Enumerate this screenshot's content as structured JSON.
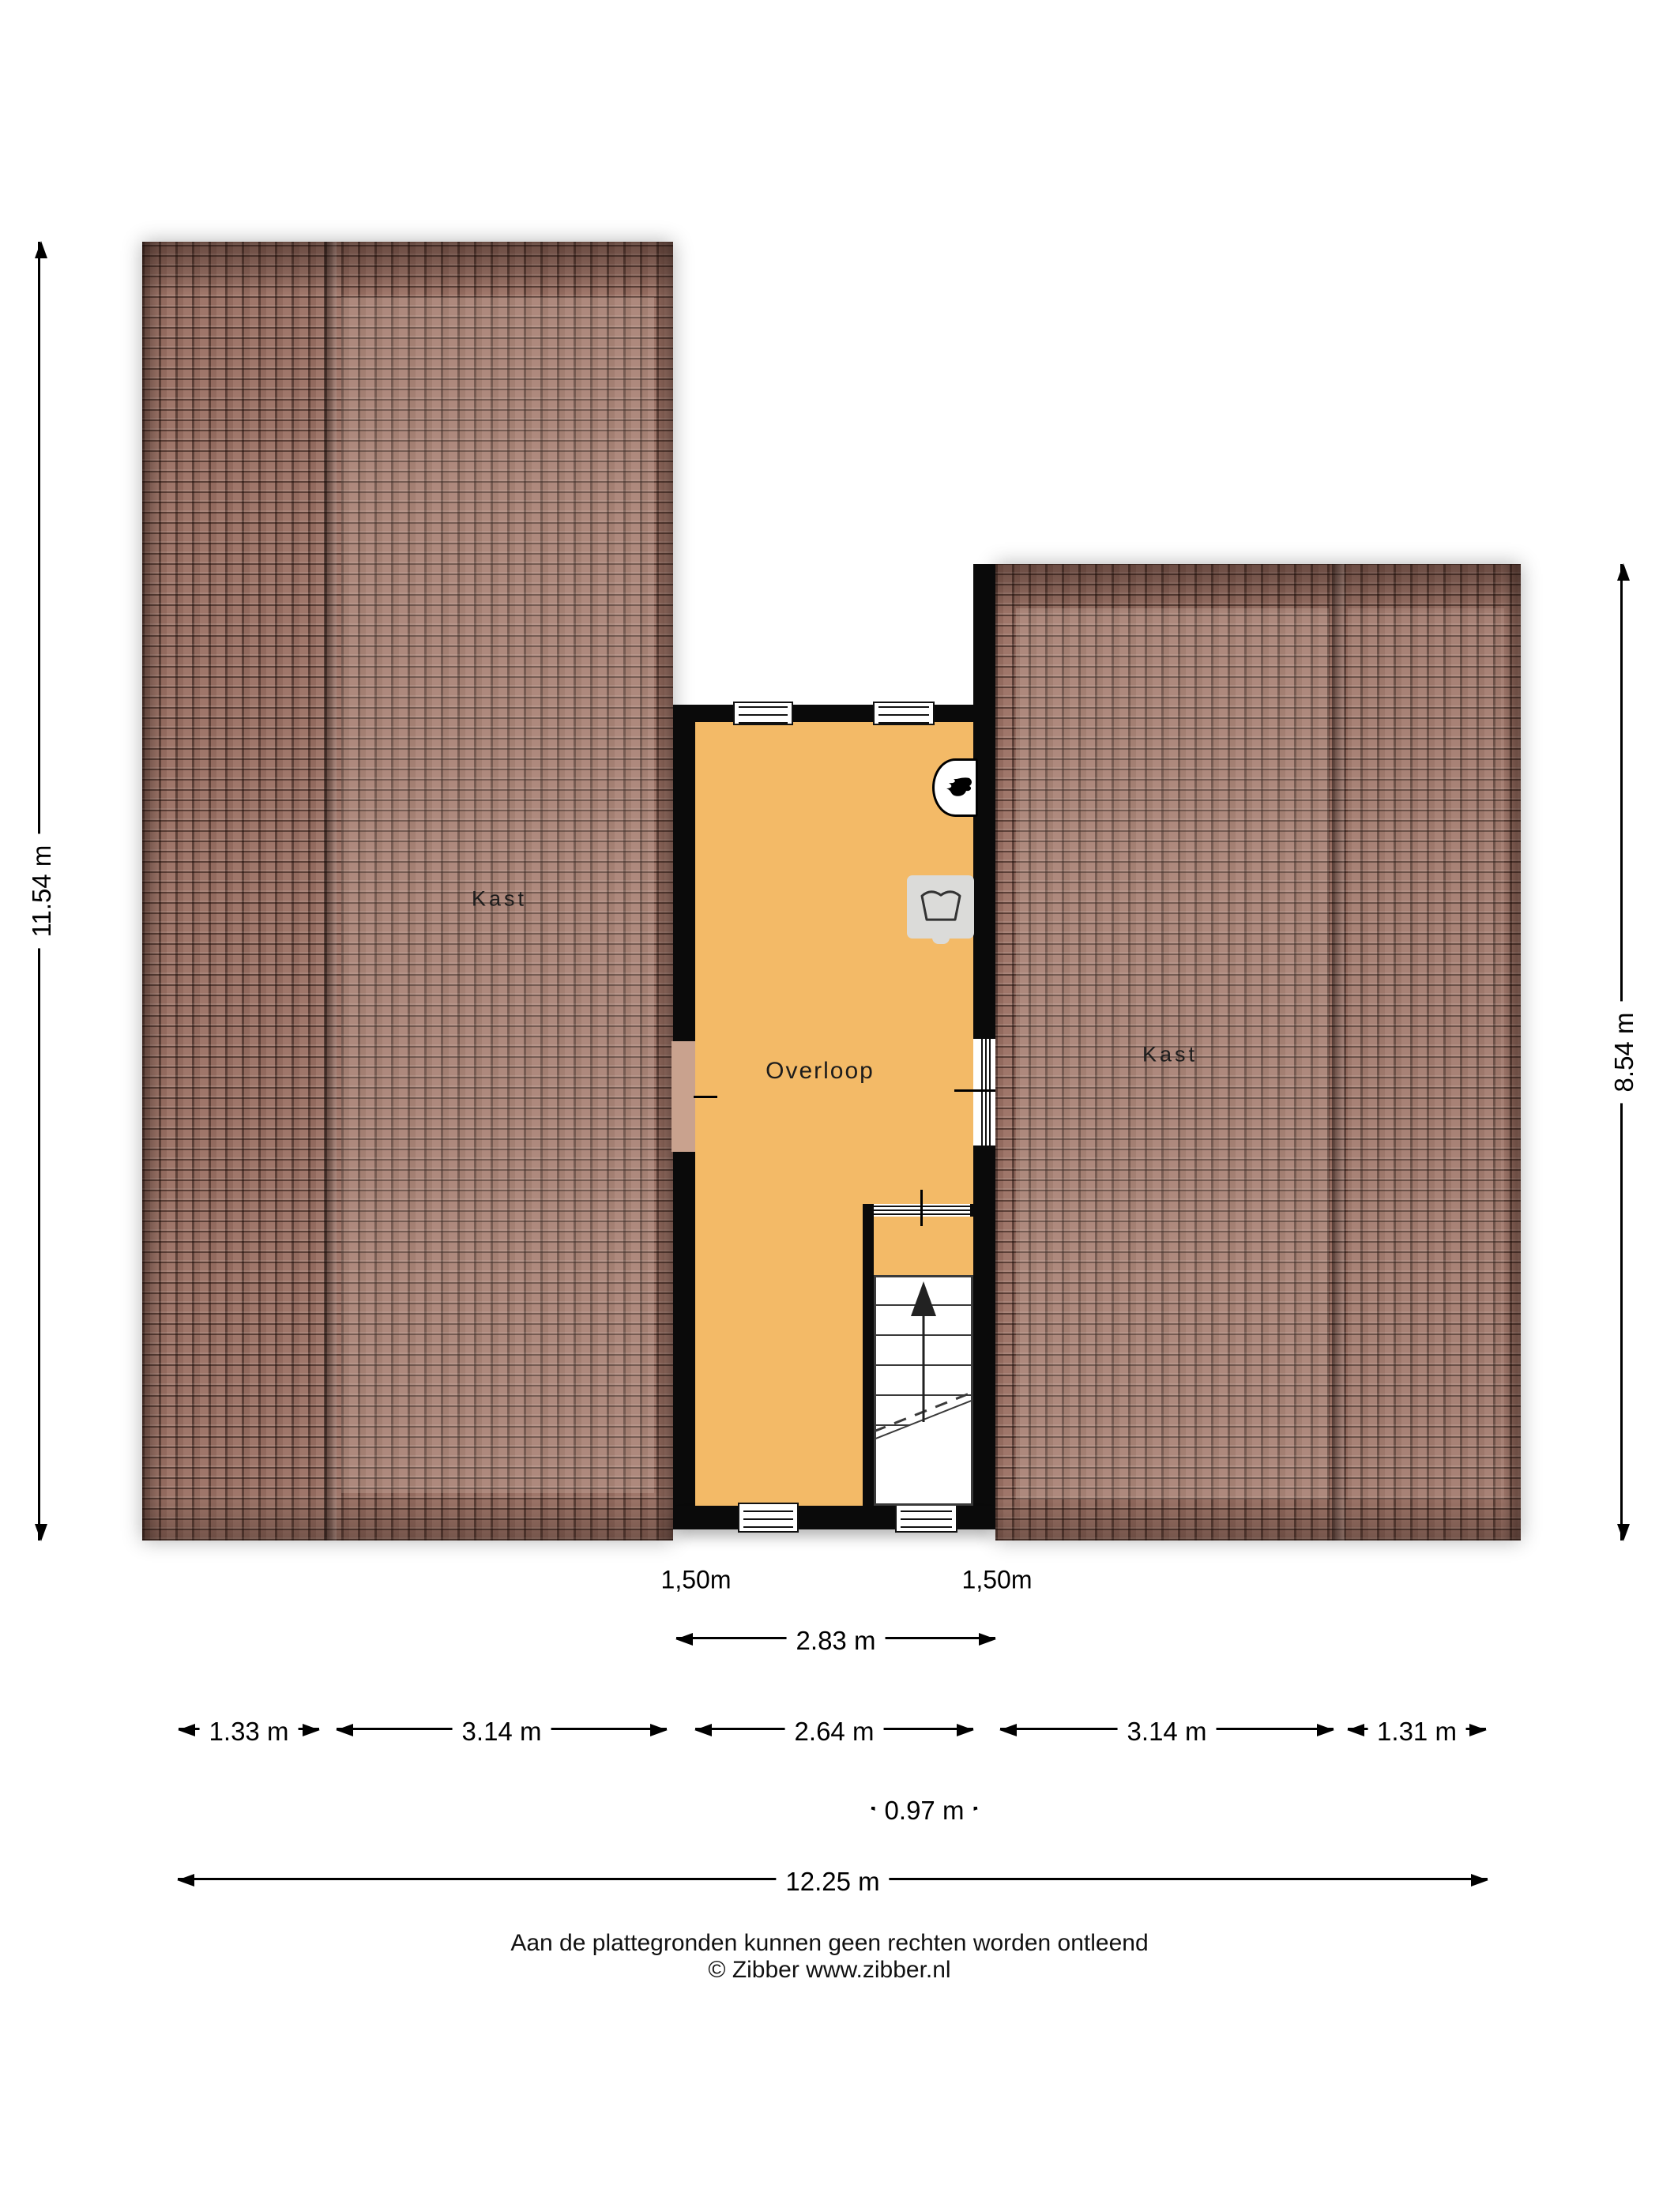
{
  "rooms": {
    "left": "Kast",
    "center": "Overloop",
    "right": "Kast"
  },
  "height_labels": {
    "window_left": "1,50m",
    "window_right": "1,50m"
  },
  "dimensions": {
    "left_height": "11.54 m",
    "right_height": "8.54 m",
    "overloop_width": "2.83 m",
    "stair_width": "0.97 m",
    "total_width": "12.25 m",
    "bottom_row": [
      "1.33 m",
      "3.14 m",
      "2.64 m",
      "3.14 m",
      "1.31 m"
    ]
  },
  "footer": {
    "disclaimer": "Aan de plattegronden kunnen geen rechten worden ontleend",
    "copyright": "© Zibber www.zibber.nl"
  },
  "icons": {
    "boiler": "flame-icon",
    "laundry": "wash-tub-icon",
    "stairs": "stairs-up-arrow-icon"
  },
  "colors": {
    "floor": "#f3ba67",
    "roof": "#9b7164",
    "wall": "#0a0a0a",
    "grey": "#dbdbd9"
  }
}
